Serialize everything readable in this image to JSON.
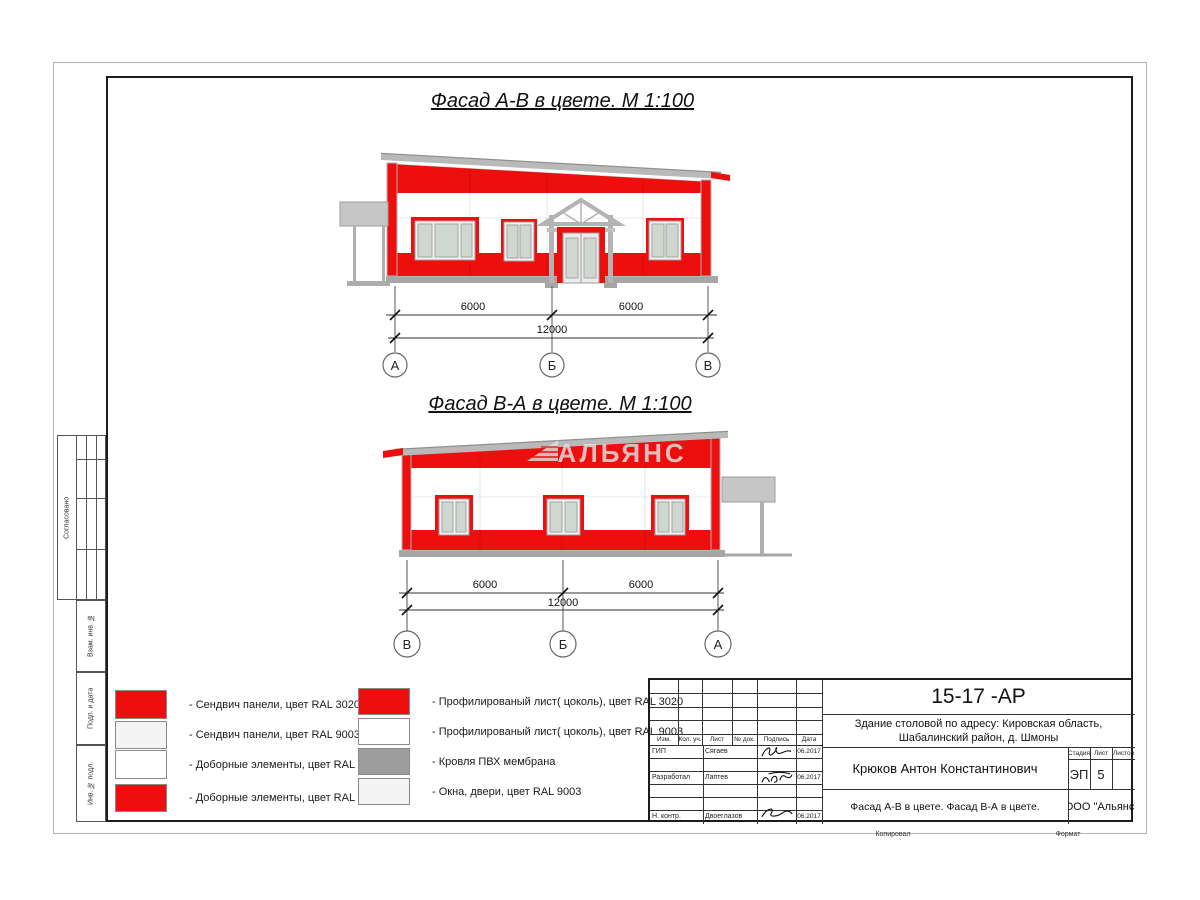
{
  "sheet": {
    "facade1": {
      "title": "Фасад А-В в цвете.  М 1:100",
      "dim_left": "6000",
      "dim_right": "6000",
      "dim_total": "12000",
      "axes": [
        "А",
        "Б",
        "В"
      ]
    },
    "facade2": {
      "title": "Фасад В-А в цвете.  М 1:100",
      "dim_left": "6000",
      "dim_right": "6000",
      "dim_total": "12000",
      "axes": [
        "В",
        "Б",
        "А"
      ]
    },
    "watermark": "АЛЬЯНС"
  },
  "legend": {
    "left": [
      {
        "color": "#ed0e0e",
        "label": "- Сендвич панели, цвет RAL 3020"
      },
      {
        "color": "#f4f4f4",
        "label": "- Сендвич панели, цвет RAL 9003"
      },
      {
        "color": "#ffffff",
        "label": "- Доборные элементы, цвет RAL 9003"
      },
      {
        "color": "#ed0e0e",
        "label": "- Доборные элементы, цвет RAL 3020"
      }
    ],
    "right": [
      {
        "color": "#ed0e0e",
        "label": "- Профилированый лист( цоколь), цвет RAL 3020"
      },
      {
        "color": "#ffffff",
        "label": "- Профилированый лист( цоколь), цвет RAL 9003"
      },
      {
        "color": "#9e9e9e",
        "label": "- Кровля ПВХ мембрана"
      },
      {
        "color": "#f4f4f4",
        "label": "- Окна, двери, цвет RAL 9003"
      }
    ]
  },
  "titleblock": {
    "doc_number": "15-17 -АР",
    "project_line1": "Здание столовой по адресу: Кировская область,",
    "project_line2": "Шабалинский район, д. Шмоны",
    "author": "Крюков Антон Константинович",
    "sheet_title": "Фасад А-В в цвете. Фасад В-А в цвете.",
    "org": "ООО \"Альянс\"",
    "col_headers": [
      "Изм.",
      "Кол. уч.",
      "Лист",
      "№ док.",
      "Подпись",
      "Дата"
    ],
    "stage_headers": [
      "Стадия",
      "Лист",
      "Листов"
    ],
    "stage_value": "ЭП",
    "sheet_value": "5",
    "sheets_value": "",
    "rows": [
      {
        "role": "ГИП",
        "name": "Сягаев",
        "date": "06.2017"
      },
      {
        "role": "Разработал",
        "name": "Лаптев",
        "date": "06.2017"
      },
      {
        "role": "Н. контр.",
        "name": "Двоеглазов",
        "date": "06.2017"
      }
    ],
    "copied_label": "Копировал",
    "format_label": "Формат"
  },
  "margin": {
    "agreed": "Согласовано",
    "vzam": "Взам. инв. №",
    "podp": "Подп. и дата",
    "inv": "Инв. № подл."
  }
}
